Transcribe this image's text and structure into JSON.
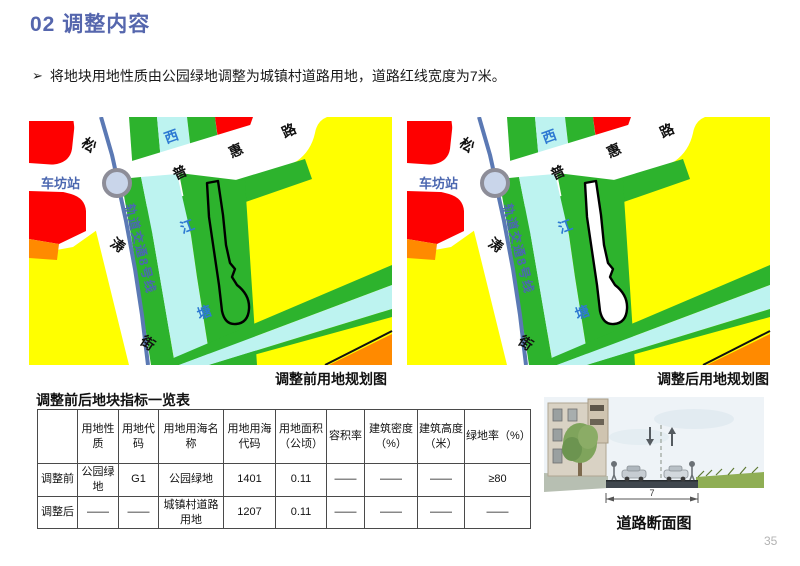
{
  "page": {
    "title": "02 调整内容",
    "bullet_marker": "➢",
    "bullet": "将地块用地性质由公园绿地调整为城镇村道路用地，道路红线宽度为7米。",
    "page_number": "35"
  },
  "maps": {
    "before_caption": "调整前用地规划图",
    "after_caption": "调整后用地规划图",
    "labels": {
      "station": "车坊站",
      "metro_line": "轨道交通8号线",
      "road_vertical": [
        "松",
        "涛",
        "街"
      ],
      "road_diagonal": [
        "普",
        "惠",
        "路"
      ],
      "river": [
        "西",
        "江",
        "塘"
      ]
    },
    "colors": {
      "red": "#fe0000",
      "orange": "#ff8a00",
      "yellow": "#ffff00",
      "green": "#2db32d",
      "water": "#bdf3f0",
      "station_fill": "#c9d5ea",
      "station_ring": "#8d8d98",
      "metro_line": "#5b79b4",
      "river_label": "#2e7ad2",
      "metro_label": "#4b67b0",
      "parcel_outline": "#000000",
      "parcel_fill_before": "#2db32d",
      "parcel_fill_after": "#ffffff"
    }
  },
  "table": {
    "title": "调整前后地块指标一览表",
    "headers": [
      "",
      "用地性质",
      "用地代码",
      "用地用海名称",
      "用地用海代码",
      "用地面积（公顷）",
      "容积率",
      "建筑密度（%）",
      "建筑高度（米）",
      "绿地率（%）"
    ],
    "rows": [
      [
        "调整前",
        "公园绿地",
        "G1",
        "公园绿地",
        "1401",
        "0.11",
        "——",
        "——",
        "——",
        "≥80"
      ],
      [
        "调整后",
        "——",
        "——",
        "城镇村道路用地",
        "1207",
        "0.11",
        "——",
        "——",
        "——",
        "——"
      ]
    ]
  },
  "section": {
    "caption": "道路断面图",
    "width_label": "7"
  }
}
